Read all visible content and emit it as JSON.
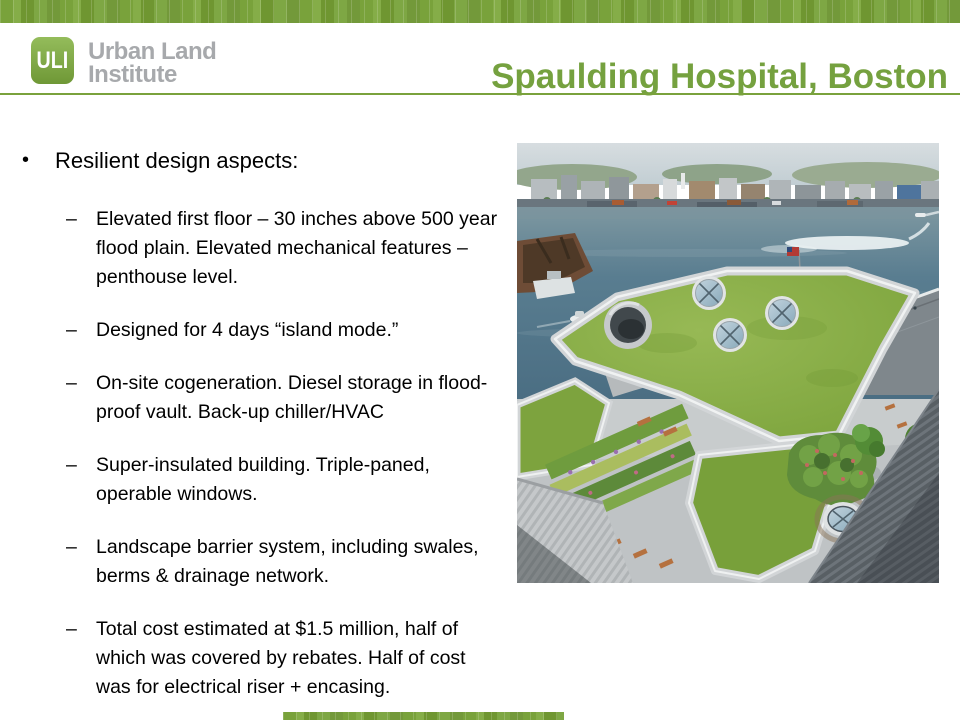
{
  "slide": {
    "title": "Spaulding Hospital, Boston",
    "logo": {
      "mark": "ULI",
      "org_line1": "Urban Land",
      "org_line2": "Institute"
    },
    "colors": {
      "accent_green": "#7aa23c",
      "title_green": "#75a13f",
      "logo_gray": "#a7a9ac"
    },
    "bullets": {
      "main_marker": "•",
      "main": "Resilient design aspects:",
      "sub_marker": "–",
      "sub": [
        {
          "lines": [
            "Elevated first floor – 30 inches above 500 year",
            "flood plain. Elevated mechanical features –",
            "penthouse level."
          ]
        },
        {
          "lines": [
            "Designed for 4 days “island mode.”"
          ]
        },
        {
          "lines": [
            "On-site cogeneration. Diesel storage in flood-",
            "proof vault. Back-up chiller/HVAC"
          ]
        },
        {
          "lines": [
            "Super-insulated building. Triple-paned,",
            "operable windows."
          ]
        },
        {
          "lines": [
            "Landscape barrier system, including swales,",
            "berms & drainage network."
          ]
        },
        {
          "lines": [
            "Total cost estimated at $1.5 million, half of",
            "which was covered by rebates. Half of cost",
            "was for electrical riser + encasing."
          ]
        }
      ]
    },
    "photo": {
      "description": "Aerial view of Spaulding Hospital green roof with circular skylights, terraces and Boston harbor"
    }
  }
}
